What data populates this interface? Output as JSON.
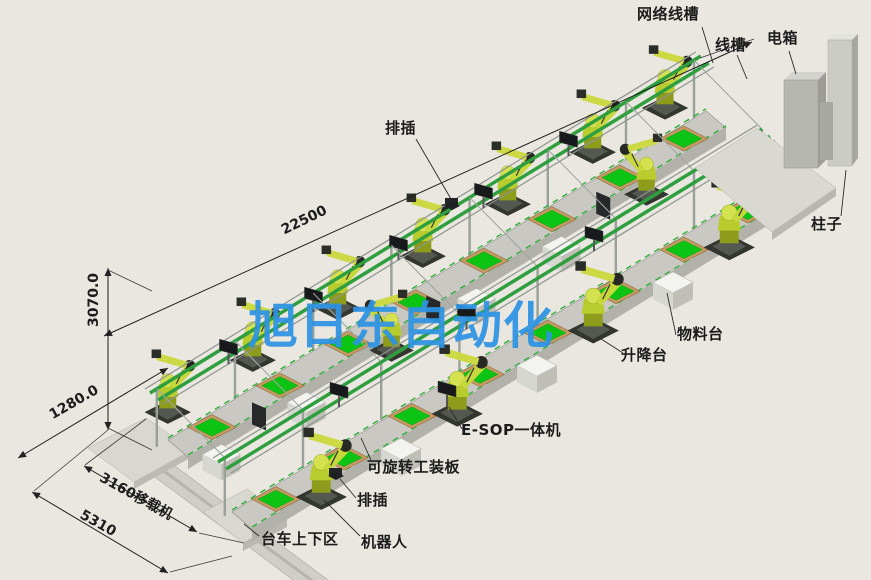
{
  "drawing": {
    "watermark": "旭日东自动化",
    "dims": {
      "d22500": "22500",
      "d3070": "3070.0",
      "d1280": "1280.0",
      "d3160": "3160移载机",
      "d5310": "5310"
    },
    "labels": {
      "network_trunking": "网络线槽",
      "trunking": "线槽",
      "electric_box": "电箱",
      "pillar": "柱子",
      "power_strip_top": "排插",
      "material_table": "物料台",
      "lift_table": "升降台",
      "esop": "E-SOP一体机",
      "rotatable_fixture_plate": "可旋转工装板",
      "power_strip_bottom": "排插",
      "trolley_load_area": "台车上下区",
      "robot": "机器人"
    },
    "colors": {
      "background": "#e9e7e0",
      "watermark_blue": "#2e94e4",
      "annotation_black": "#1c1c1c",
      "robot_yellow": "#c6d83b",
      "pallet_green": "#0cc414",
      "pallet_board_tan": "#c59a62",
      "rail_green": "#2f9e3f",
      "frame_grey": "#9a9e9a",
      "table_white": "#f3f3ef",
      "cabinet_grey": "#b7b7b2"
    }
  }
}
